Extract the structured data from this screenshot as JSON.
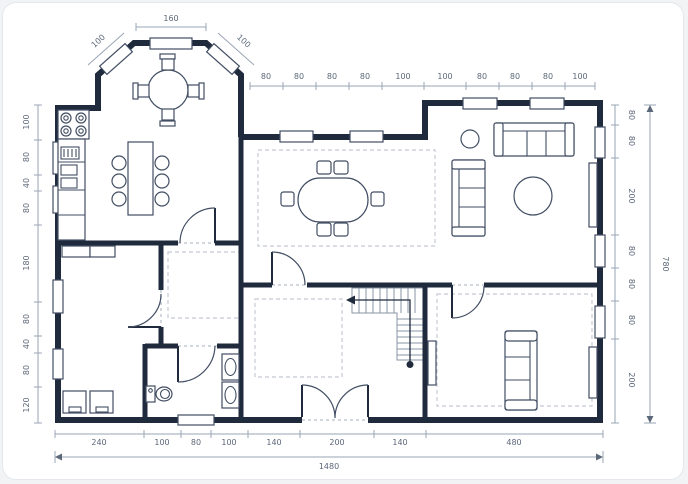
{
  "title": "house-floor-plan",
  "colors": {
    "bg": "#ffffff",
    "outer": "#f1f3f5",
    "border": "#e4e7ec",
    "wall": "#1f2a3c",
    "furn": "#424e63",
    "dim": "#9aa4b5",
    "dimtext": "#5c6779",
    "dash": "#c4cad4",
    "stair": "#8a94a6"
  },
  "dimensions": {
    "bay_top": "160",
    "bay_left": "100",
    "bay_right": "100",
    "top": [
      "80",
      "80",
      "80",
      "80",
      "100",
      "100",
      "80",
      "80",
      "80",
      "100"
    ],
    "left": [
      "100",
      "80",
      "40",
      "80",
      "180",
      "80",
      "40",
      "80",
      "120"
    ],
    "right": [
      "80",
      "80",
      "200",
      "80",
      "80",
      "80",
      "200"
    ],
    "right_total": "780",
    "bottom": [
      "240",
      "100",
      "80",
      "100",
      "140",
      "200",
      "140",
      "480"
    ],
    "bottom_total": "1480"
  },
  "furniture": [
    "gas-stove",
    "kitchen-counter",
    "kitchen-sink",
    "kitchen-table",
    "kitchen-stools",
    "bay-round-table",
    "bay-chairs",
    "office-desk",
    "office-chairs",
    "toilet",
    "bathroom-sinks",
    "oval-dining-table",
    "dining-chairs",
    "three-seat-sofa",
    "two-seat-sofa",
    "coffee-table",
    "side-table",
    "console",
    "bed",
    "wardrobe",
    "dresser",
    "staircase",
    "entry-double-door",
    "area-rugs"
  ]
}
